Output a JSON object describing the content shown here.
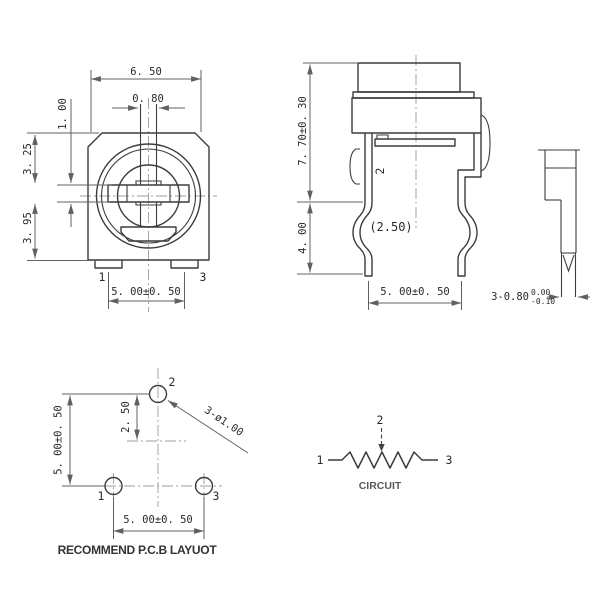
{
  "front_view": {
    "width": "6. 50",
    "slot_width": "0. 80",
    "slot_height": "1. 00",
    "upper": "3. 25",
    "lower": "3. 95",
    "pin_pitch": "5. 00±0. 50",
    "pin1": "1",
    "pin3": "3"
  },
  "side_view": {
    "height": "7. 70±0. 30",
    "lead_length": "4. 00",
    "center_offset": "(2.50)",
    "pin_pitch": "5. 00±0. 50",
    "pin2": "2"
  },
  "pin_detail": {
    "dim": "3-0.80",
    "tol_upper": "0.00",
    "tol_lower": "-0.10"
  },
  "pcb_layout": {
    "title": "RECOMMEND P.C.B LAYUOT",
    "vertical_pitch": "5. 00±0. 50",
    "hole2_offset": "2. 50",
    "hole_callout": "3-ø1.00",
    "horizontal_pitch": "5. 00±0. 50",
    "hole1": "1",
    "hole2": "2",
    "hole3": "3"
  },
  "circuit": {
    "title": "CIRCUIT",
    "terminal1": "1",
    "terminal2": "2",
    "terminal3": "3"
  },
  "colors": {
    "outline": "#3c3c3c",
    "dimension": "#606060",
    "centerline": "#9c9c9c",
    "text": "#2a2a2a",
    "background": "#ffffff"
  }
}
